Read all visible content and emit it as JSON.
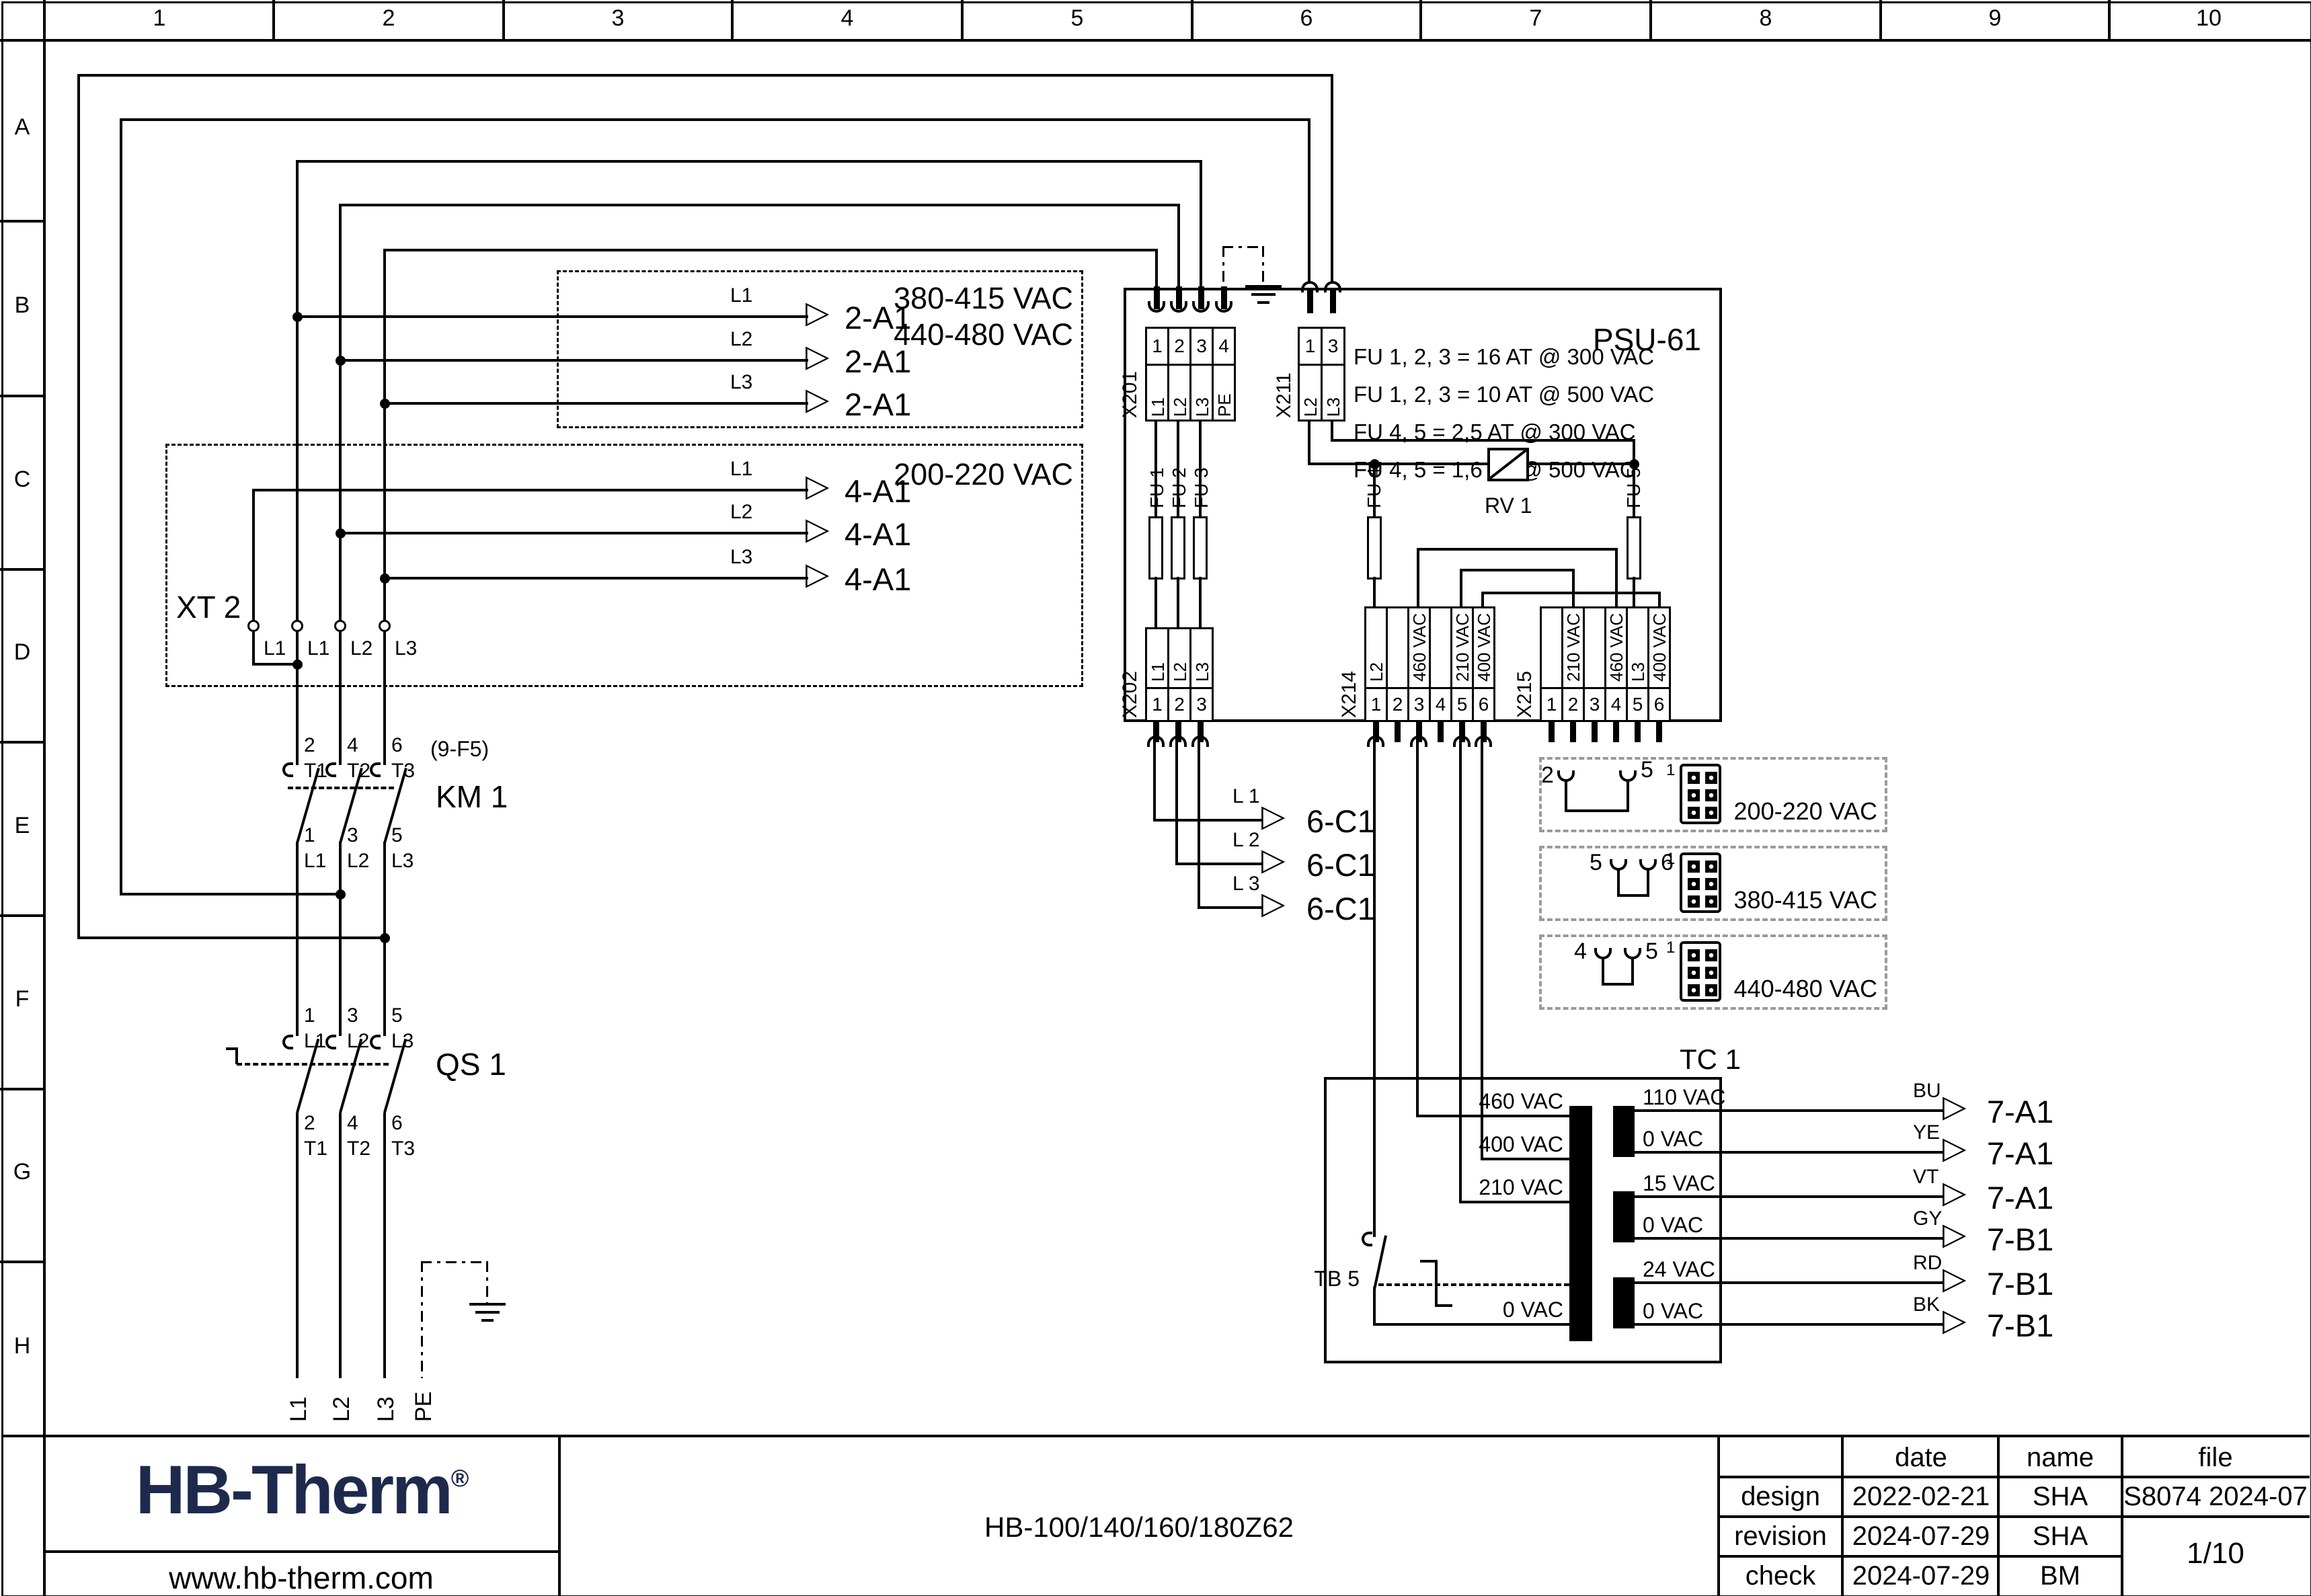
{
  "sheet": {
    "cols": [
      "1",
      "2",
      "3",
      "4",
      "5",
      "6",
      "7",
      "8",
      "9",
      "10"
    ],
    "rows": [
      "A",
      "B",
      "C",
      "D",
      "E",
      "F",
      "G",
      "H"
    ]
  },
  "feed1": {
    "range_a": "380-415 VAC",
    "range_b": "440-480 VAC",
    "phases": [
      "L1",
      "L2",
      "L3"
    ],
    "target": "2-A1"
  },
  "feed2": {
    "range": "200-220 VAC",
    "terminal": "XT 2",
    "xt_labels": [
      "L1",
      "L1",
      "L2",
      "L3"
    ],
    "phases": [
      "L1",
      "L2",
      "L3"
    ],
    "target": "4-A1"
  },
  "km1": {
    "label": "KM 1",
    "ref": "(9-F5)",
    "top_nums": [
      "2",
      "4",
      "6"
    ],
    "top_lbls": [
      "T1",
      "T2",
      "T3"
    ],
    "bot_nums": [
      "1",
      "3",
      "5"
    ],
    "bot_lbls": [
      "L1",
      "L2",
      "L3"
    ]
  },
  "qs1": {
    "label": "QS 1",
    "top_nums": [
      "1",
      "3",
      "5"
    ],
    "top_lbls": [
      "L1",
      "L2",
      "L3"
    ],
    "bot_nums": [
      "2",
      "4",
      "6"
    ],
    "bot_lbls": [
      "T1",
      "T2",
      "T3"
    ]
  },
  "mains": {
    "labels": [
      "L1",
      "L2",
      "L3",
      "PE"
    ]
  },
  "psu": {
    "title": "PSU-61",
    "notes": [
      "FU 1, 2, 3 = 16 AT @ 300 VAC",
      "FU 1, 2, 3 = 10 AT @ 500 VAC",
      "FU 4, 5 = 2,5 AT @ 300 VAC",
      "FU 4, 5 = 1,6 AT @ 500 VAC"
    ],
    "x201": {
      "name": "X201",
      "nums": [
        "1",
        "2",
        "3",
        "4"
      ],
      "lbls": [
        "L1",
        "L2",
        "L3",
        "PE"
      ]
    },
    "x211": {
      "name": "X211",
      "nums": [
        "1",
        "3"
      ],
      "lbls": [
        "L2",
        "L3"
      ]
    },
    "x202": {
      "name": "X202",
      "nums": [
        "1",
        "2",
        "3"
      ],
      "lbls": [
        "L1",
        "L2",
        "L3"
      ]
    },
    "x214": {
      "name": "X214",
      "nums": [
        "1",
        "2",
        "3",
        "4",
        "5",
        "6"
      ],
      "lbls": [
        "L2",
        "",
        "460 VAC",
        "",
        "210 VAC",
        "400 VAC"
      ]
    },
    "x215": {
      "name": "X215",
      "nums": [
        "1",
        "2",
        "3",
        "4",
        "5",
        "6"
      ],
      "lbls": [
        "",
        "210 VAC",
        "",
        "460 VAC",
        "L3",
        "400 VAC"
      ]
    },
    "fu": [
      "FU 1",
      "FU 2",
      "FU 3",
      "FU 4",
      "FU 5"
    ],
    "rv": "RV 1"
  },
  "out6": {
    "phases": [
      "L 1",
      "L 2",
      "L 3"
    ],
    "target": "6-C1"
  },
  "options": {
    "pin_one": "1",
    "items": [
      {
        "p1": "2",
        "p2": "5",
        "range": "200-220 VAC"
      },
      {
        "p1": "5",
        "p2": "6",
        "range": "380-415 VAC"
      },
      {
        "p1": "4",
        "p2": "5",
        "range": "440-480 VAC"
      }
    ]
  },
  "tc1": {
    "label": "TC 1",
    "tb": "TB 5",
    "prim": [
      "460 VAC",
      "400 VAC",
      "210 VAC",
      "0 VAC"
    ],
    "sec": [
      "110 VAC",
      "0 VAC",
      "15 VAC",
      "0 VAC",
      "24 VAC",
      "0 VAC"
    ],
    "outs": [
      {
        "c": "BU",
        "t": "7-A1"
      },
      {
        "c": "YE",
        "t": "7-A1"
      },
      {
        "c": "VT",
        "t": "7-A1"
      },
      {
        "c": "GY",
        "t": "7-B1"
      },
      {
        "c": "RD",
        "t": "7-B1"
      },
      {
        "c": "BK",
        "t": "7-B1"
      }
    ]
  },
  "title_block": {
    "logo": "HB-Therm",
    "reg": "®",
    "site": "www.hb-therm.com",
    "doc": "HB-100/140/160/180Z62",
    "h_date": "date",
    "h_name": "name",
    "h_file": "file",
    "r1": [
      "design",
      "2022-02-21",
      "SHA"
    ],
    "r2": [
      "revision",
      "2024-07-29",
      "SHA"
    ],
    "r3": [
      "check",
      "2024-07-29",
      "BM"
    ],
    "file_value": "S8074 2024-07",
    "page": "1/10",
    "logo_color": "#1e2a4d"
  }
}
